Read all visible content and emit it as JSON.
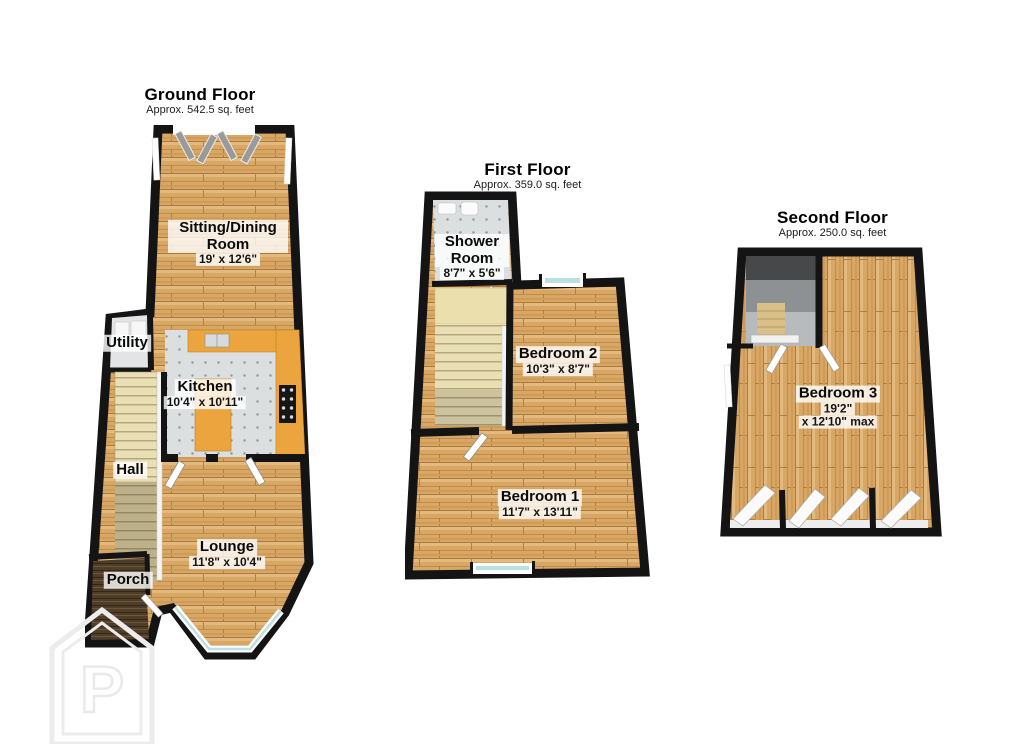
{
  "floors": [
    {
      "title": "Ground Floor",
      "subtitle": "Approx. 542.5 sq. feet",
      "rooms": {
        "sitting_dining": {
          "name": "Sitting/Dining Room",
          "dims": "19' x 12'6\""
        },
        "utility": {
          "name": "Utility"
        },
        "kitchen": {
          "name": "Kitchen",
          "dims": "10'4\" x 10'11\""
        },
        "hall": {
          "name": "Hall"
        },
        "lounge": {
          "name": "Lounge",
          "dims": "11'8\" x 10'4\""
        },
        "porch": {
          "name": "Porch"
        }
      }
    },
    {
      "title": "First Floor",
      "subtitle": "Approx. 359.0 sq. feet",
      "rooms": {
        "shower": {
          "name": "Shower Room",
          "dims": "8'7\" x 5'6\""
        },
        "bedroom2": {
          "name": "Bedroom 2",
          "dims": "10'3\" x 8'7\""
        },
        "bedroom1": {
          "name": "Bedroom 1",
          "dims": "11'7\" x 13'11\""
        }
      }
    },
    {
      "title": "Second Floor",
      "subtitle": "Approx. 250.0 sq. feet",
      "rooms": {
        "bedroom3": {
          "name": "Bedroom 3",
          "dims_line1": "19'2\"",
          "dims_line2": "x 12'10\" max"
        }
      }
    }
  ],
  "watermark": {
    "letter": "P"
  },
  "colors": {
    "wall": "#141414",
    "wood": "#d8a766",
    "kitchen_floor": "#dbdfe0",
    "counter": "#eca43e",
    "stairs": "#e9dfb4",
    "glass": "#bcdfe2",
    "porch_floor": "#4e3d29",
    "label_bg": "rgba(255,255,255,0.8)",
    "watermark": "#ececec"
  }
}
